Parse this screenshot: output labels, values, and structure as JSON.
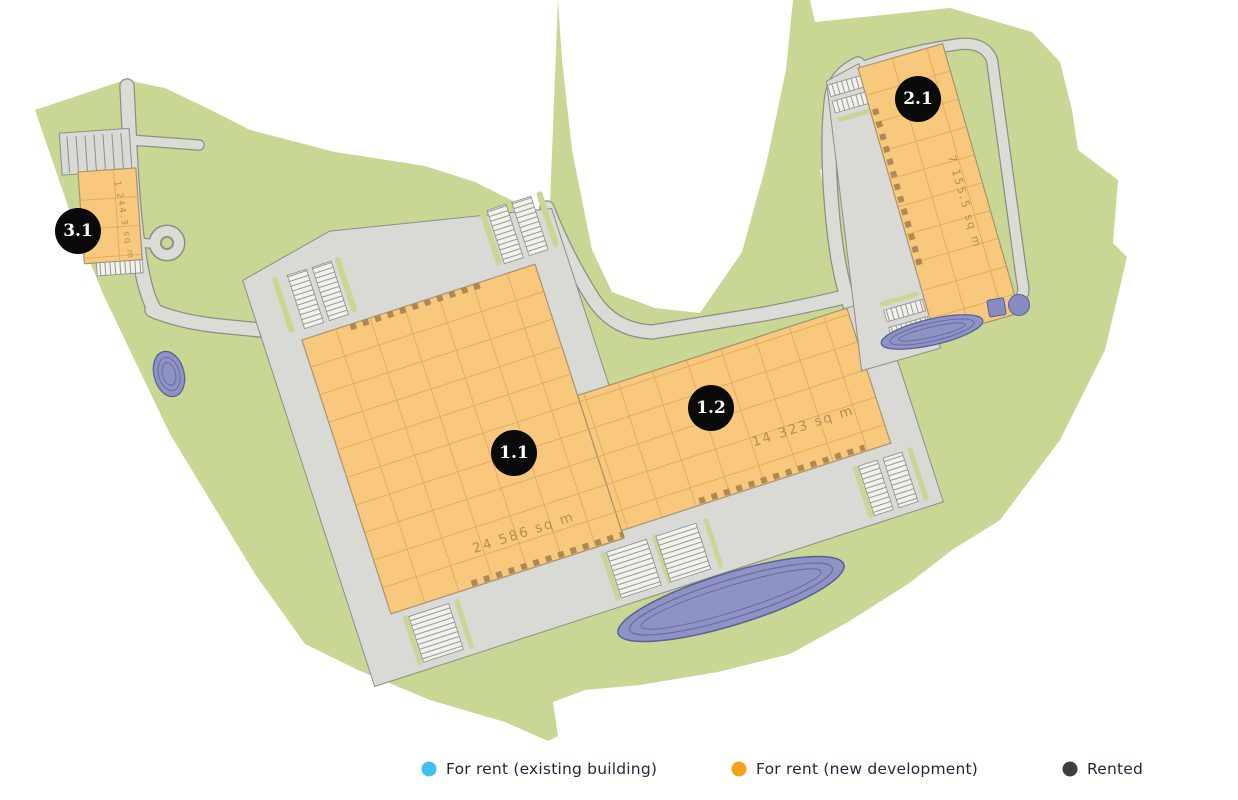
{
  "map": {
    "buildings": [
      {
        "id": "1.1",
        "area": "24 586 sq m",
        "status": "for-rent-new-development"
      },
      {
        "id": "1.2",
        "area": "14 323 sq m",
        "status": "for-rent-new-development"
      },
      {
        "id": "2.1",
        "area": "7 155.5 sq m",
        "status": "for-rent-new-development"
      },
      {
        "id": "3.1",
        "area": "1 244.3 sq m",
        "status": "for-rent-new-development"
      }
    ],
    "colors": {
      "landscape": "#c8d794",
      "road": "#dcdcd7",
      "building_for_rent_new": "#f8c87d",
      "pond": "#8e93c3",
      "marker": "#0a0a0a"
    }
  },
  "legend": {
    "items": [
      {
        "label": "For rent (existing building)",
        "color": "#3fc1ee"
      },
      {
        "label": "For rent (new development)",
        "color": "#f7a21b"
      },
      {
        "label": "Rented",
        "color": "#3e3e40"
      }
    ]
  }
}
